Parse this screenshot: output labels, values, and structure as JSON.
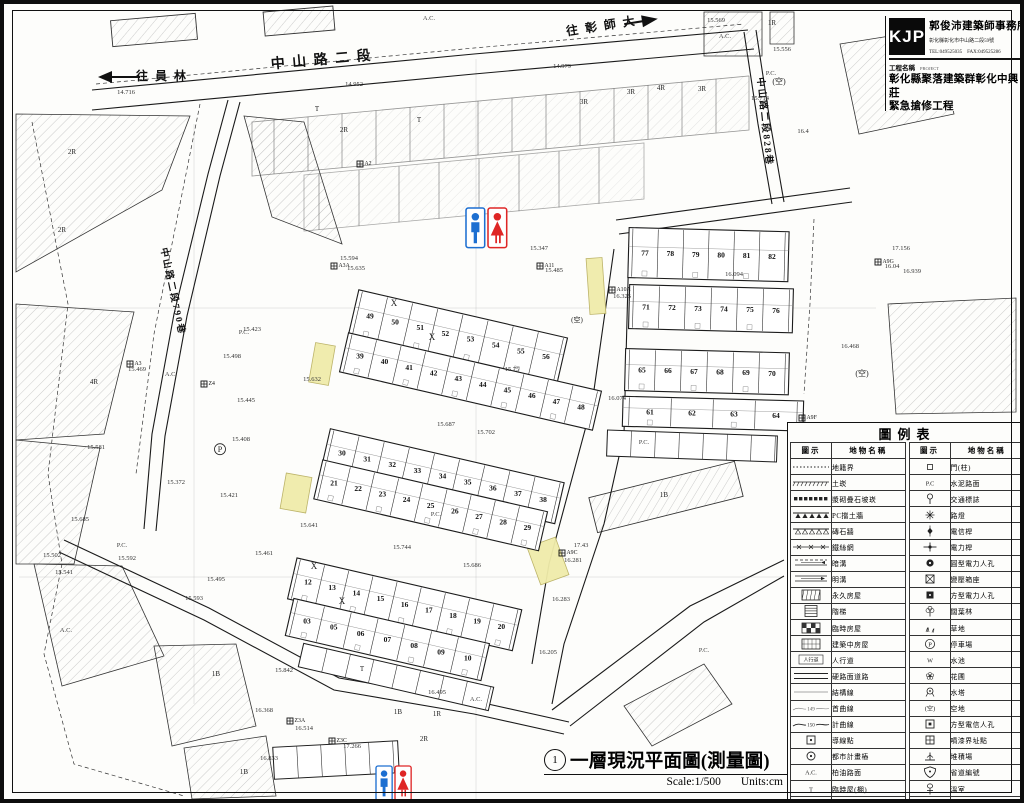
{
  "title_block": {
    "logo": "KJP",
    "office": "郭俊沛建築師事務所",
    "address": "彰化縣彰化市中山路二段59號",
    "tel_fax": "TEL:049525035　FAX:049525286",
    "project_label": "工程名稱",
    "project_label_en": "PROJECT",
    "project_name_line1": "彰化縣聚落建築群彰化中興莊",
    "project_name_line2": "緊急搶修工程"
  },
  "footer": {
    "number": "1",
    "title": "一層現況平面圖(測量圖)",
    "scale": "Scale:1/500",
    "units": "Units:cm"
  },
  "legend": {
    "title": "圖例表",
    "col_symbol": "圖示",
    "col_name": "地物名稱",
    "left": [
      {
        "sym": "dotted",
        "name": "地籍界"
      },
      {
        "sym": "ticks",
        "name": "土崁"
      },
      {
        "sym": "blocks",
        "name": "漿砌疊石坡崁"
      },
      {
        "sym": "tri_solid",
        "name": "PC擋土牆"
      },
      {
        "sym": "tri_open",
        "name": "磚石牆"
      },
      {
        "sym": "xfence",
        "name": "鐵絲網"
      },
      {
        "sym": "ditch_dash",
        "name": "暗溝"
      },
      {
        "sym": "ditch_solid",
        "name": "明溝"
      },
      {
        "sym": "hatch_box",
        "name": "永久房屋"
      },
      {
        "sym": "stairs",
        "name": "階梯"
      },
      {
        "sym": "checker_box",
        "name": "臨時房屋"
      },
      {
        "sym": "hatch_box2",
        "name": "建築中房屋"
      },
      {
        "sym": "sidewalk",
        "name": "人行道",
        "symText": "人行道"
      },
      {
        "sym": "dbl_line",
        "name": "硬路面道路"
      },
      {
        "sym": "thin_line",
        "name": "結構線"
      },
      {
        "sym": "contour",
        "name": "首曲線",
        "symText": "149"
      },
      {
        "sym": "contour2",
        "name": "計曲線",
        "symText": "150"
      },
      {
        "sym": "sq_dot",
        "name": "導線點"
      },
      {
        "sym": "circ_dot",
        "name": "都市計畫樁"
      },
      {
        "sym": "textsym",
        "name": "柏油路面",
        "symText": "A.C."
      },
      {
        "sym": "textsym",
        "name": "臨時屋(棚)",
        "symText": "T"
      },
      {
        "sym": "brick_house",
        "name": "磚砌屋"
      }
    ],
    "right": [
      {
        "sym": "sq_tiny",
        "name": "門(柱)"
      },
      {
        "sym": "textsym",
        "name": "水泥路面",
        "symText": "P.C"
      },
      {
        "sym": "traffic",
        "name": "交通標誌"
      },
      {
        "sym": "light",
        "name": "路燈"
      },
      {
        "sym": "pole_t",
        "name": "電信桿"
      },
      {
        "sym": "pole_e",
        "name": "電力桿"
      },
      {
        "sym": "mh_round",
        "name": "圓型電力人孔"
      },
      {
        "sym": "transformer",
        "name": "變壓箱座"
      },
      {
        "sym": "mh_square",
        "name": "方型電力人孔"
      },
      {
        "sym": "tree",
        "name": "闊葉林"
      },
      {
        "sym": "grass",
        "name": "草地"
      },
      {
        "sym": "parkP",
        "name": "停車場",
        "symText": "P"
      },
      {
        "sym": "textsym",
        "name": "水池",
        "symText": "W"
      },
      {
        "sym": "flower",
        "name": "花圃"
      },
      {
        "sym": "wtower",
        "name": "水塔"
      },
      {
        "sym": "textsym",
        "name": "空地",
        "symText": "(空)"
      },
      {
        "sym": "mh_tel",
        "name": "方型電信人孔"
      },
      {
        "sym": "paint_pt",
        "name": "噴漆界址點"
      },
      {
        "sym": "pile",
        "name": "堆積場"
      },
      {
        "sym": "shield",
        "name": "省道編號"
      },
      {
        "sym": "greenhouse",
        "name": "溫室"
      },
      {
        "sym": "flow",
        "name": "水流方向"
      }
    ]
  },
  "map": {
    "colors": {
      "highlight": "#f0ecaa",
      "highlight_border": "#b9b062",
      "man_blue": "#1d6fd1",
      "woman_red": "#df2626",
      "ink": "#1a1a1a"
    },
    "central_angle": 13,
    "right_angle": 1.5,
    "central_rows": [
      {
        "nums": [
          "49",
          "50",
          "51",
          "52",
          "53",
          "54",
          "55",
          "56"
        ],
        "x": 366,
        "y": 312,
        "dx": 25.8,
        "h": 46
      },
      {
        "nums": [
          "39",
          "40",
          "41",
          "42",
          "43",
          "44",
          "45",
          "46",
          "47",
          "48"
        ],
        "x": 356,
        "y": 352,
        "dx": 25.2,
        "h": 40
      },
      {
        "nums": [
          "30",
          "31",
          "32",
          "33",
          "34",
          "35",
          "36",
          "37",
          "38"
        ],
        "x": 338,
        "y": 449,
        "dx": 25.8,
        "h": 42
      },
      {
        "nums": [
          "21",
          "22",
          "23",
          "24",
          "25",
          "26",
          "27",
          "28",
          "29"
        ],
        "x": 330,
        "y": 479,
        "dx": 24.8,
        "h": 40
      },
      {
        "nums": [
          "12",
          "13",
          "14",
          "15",
          "16",
          "17",
          "18",
          "19",
          "20"
        ],
        "x": 304,
        "y": 578,
        "dx": 24.8,
        "h": 42
      },
      {
        "nums": [
          "03",
          "05",
          "06",
          "07",
          "08",
          "09",
          "10"
        ],
        "x": 303,
        "y": 617,
        "dx": 27.5,
        "h": 38
      }
    ],
    "right_rows": [
      {
        "nums": [
          "77",
          "78",
          "79",
          "80",
          "81",
          "82"
        ],
        "x": 641,
        "y": 249,
        "dx": 25.4,
        "h": 50
      },
      {
        "nums": [
          "71",
          "72",
          "73",
          "74",
          "75",
          "76"
        ],
        "x": 642,
        "y": 303,
        "dx": 26,
        "h": 44
      },
      {
        "nums": [
          "65",
          "66",
          "67",
          "68",
          "69",
          "70"
        ],
        "x": 638,
        "y": 366,
        "dx": 26,
        "h": 42
      },
      {
        "nums": [
          "61",
          "62",
          "63",
          "64"
        ],
        "x": 646,
        "y": 408,
        "dx": 42,
        "h": 30
      }
    ],
    "markers": [
      {
        "c": "A2",
        "x": 356,
        "y": 160
      },
      {
        "c": "Z4",
        "x": 200,
        "y": 380
      },
      {
        "c": "A3",
        "x": 126,
        "y": 360
      },
      {
        "c": "A3A",
        "x": 330,
        "y": 262
      },
      {
        "c": "A11",
        "x": 536,
        "y": 262
      },
      {
        "c": "A10A",
        "x": 608,
        "y": 286
      },
      {
        "c": "A9G",
        "x": 874,
        "y": 258
      },
      {
        "c": "A9C",
        "x": 558,
        "y": 549
      },
      {
        "c": "A9F",
        "x": 798,
        "y": 414
      },
      {
        "c": "Z3A",
        "x": 286,
        "y": 717
      },
      {
        "c": "Z3C",
        "x": 328,
        "y": 737
      }
    ],
    "labels": [
      {
        "t": "中 山 路 二 段",
        "x": 318,
        "y": 60,
        "s": 14,
        "r": -5,
        "k": "road"
      },
      {
        "t": "往 彰 師 大",
        "x": 598,
        "y": 26,
        "s": 12,
        "r": -9,
        "k": "road"
      },
      {
        "t": "往 員 林",
        "x": 158,
        "y": 76,
        "s": 12,
        "r": 0,
        "k": "road"
      },
      {
        "t": "中山路二段790巷",
        "x": 166,
        "y": 288,
        "s": 9.5,
        "r": 78,
        "k": "road"
      },
      {
        "t": "中山路二段828巷",
        "x": 758,
        "y": 118,
        "s": 9.5,
        "r": 84,
        "k": "road"
      },
      {
        "t": "(空)",
        "x": 775,
        "y": 80,
        "s": 8,
        "k": "area"
      },
      {
        "t": "(空)",
        "x": 858,
        "y": 372,
        "s": 8,
        "k": "area"
      },
      {
        "t": "(空)",
        "x": 573,
        "y": 318,
        "s": 7,
        "k": "area"
      },
      {
        "t": "1R",
        "x": 768,
        "y": 21,
        "s": 7,
        "k": "area"
      },
      {
        "t": "1R",
        "x": 433,
        "y": 712,
        "s": 7,
        "k": "area"
      },
      {
        "t": "2R",
        "x": 68,
        "y": 150,
        "s": 7,
        "k": "area"
      },
      {
        "t": "2R",
        "x": 58,
        "y": 228,
        "s": 7,
        "k": "area"
      },
      {
        "t": "2R",
        "x": 340,
        "y": 128,
        "s": 7,
        "k": "area"
      },
      {
        "t": "2R",
        "x": 420,
        "y": 737,
        "s": 7,
        "k": "area"
      },
      {
        "t": "3R",
        "x": 580,
        "y": 100,
        "s": 7,
        "k": "area"
      },
      {
        "t": "3R",
        "x": 627,
        "y": 90,
        "s": 7,
        "k": "area"
      },
      {
        "t": "4R",
        "x": 657,
        "y": 86,
        "s": 7,
        "k": "area"
      },
      {
        "t": "3R",
        "x": 698,
        "y": 87,
        "s": 7,
        "k": "area"
      },
      {
        "t": "4R",
        "x": 90,
        "y": 380,
        "s": 7,
        "k": "area"
      },
      {
        "t": "1B",
        "x": 212,
        "y": 672,
        "s": 7,
        "k": "area"
      },
      {
        "t": "1B",
        "x": 240,
        "y": 770,
        "s": 7,
        "k": "area"
      },
      {
        "t": "1B",
        "x": 394,
        "y": 710,
        "s": 7,
        "k": "area"
      },
      {
        "t": "1B",
        "x": 660,
        "y": 493,
        "s": 7,
        "k": "area"
      },
      {
        "t": "T",
        "x": 313,
        "y": 107,
        "s": 7,
        "k": "area"
      },
      {
        "t": "T",
        "x": 415,
        "y": 118,
        "s": 7,
        "k": "area"
      },
      {
        "t": "T",
        "x": 358,
        "y": 667,
        "s": 7,
        "k": "area"
      },
      {
        "t": "P.C.",
        "x": 240,
        "y": 330,
        "s": 6.5,
        "k": "surf"
      },
      {
        "t": "P.C.",
        "x": 118,
        "y": 543,
        "s": 6.5,
        "k": "surf"
      },
      {
        "t": "P.C.",
        "x": 432,
        "y": 512,
        "s": 6.5,
        "k": "surf"
      },
      {
        "t": "P.C.",
        "x": 767,
        "y": 71,
        "s": 6.5,
        "k": "surf"
      },
      {
        "t": "P.C.",
        "x": 640,
        "y": 440,
        "s": 6.5,
        "k": "surf"
      },
      {
        "t": "P.C.",
        "x": 700,
        "y": 648,
        "s": 6.5,
        "k": "surf"
      },
      {
        "t": "A.C.",
        "x": 167,
        "y": 372,
        "s": 6.5,
        "k": "surf"
      },
      {
        "t": "A.C.",
        "x": 721,
        "y": 34,
        "s": 6.5,
        "k": "surf"
      },
      {
        "t": "A.C.",
        "x": 62,
        "y": 628,
        "s": 6.5,
        "k": "surf"
      },
      {
        "t": "A.C.",
        "x": 472,
        "y": 697,
        "s": 6.5,
        "k": "surf"
      },
      {
        "t": "A.C.",
        "x": 425,
        "y": 16,
        "s": 6.5,
        "k": "surf"
      },
      {
        "t": "14.716",
        "x": 122,
        "y": 90,
        "s": 6.5,
        "k": "elev"
      },
      {
        "t": "14.952",
        "x": 350,
        "y": 82,
        "s": 6.5,
        "k": "elev"
      },
      {
        "t": "14.979",
        "x": 558,
        "y": 64,
        "s": 6.5,
        "k": "elev"
      },
      {
        "t": "15.569",
        "x": 712,
        "y": 18,
        "s": 6.5,
        "k": "elev"
      },
      {
        "t": "15.556",
        "x": 778,
        "y": 47,
        "s": 6.5,
        "k": "elev"
      },
      {
        "t": "15.714",
        "x": 756,
        "y": 96,
        "s": 6.5,
        "k": "elev"
      },
      {
        "t": "16.4",
        "x": 799,
        "y": 129,
        "s": 6.5,
        "k": "elev"
      },
      {
        "t": "17.156",
        "x": 897,
        "y": 246,
        "s": 6.5,
        "k": "elev"
      },
      {
        "t": "16.939",
        "x": 908,
        "y": 269,
        "s": 6.5,
        "k": "elev"
      },
      {
        "t": "16.468",
        "x": 846,
        "y": 344,
        "s": 6.5,
        "k": "elev"
      },
      {
        "t": "16.04",
        "x": 888,
        "y": 264,
        "s": 6.5,
        "k": "elev"
      },
      {
        "t": "16.64",
        "x": 812,
        "y": 422,
        "s": 6.5,
        "k": "elev"
      },
      {
        "t": "15.594",
        "x": 345,
        "y": 256,
        "s": 6.5,
        "k": "elev"
      },
      {
        "t": "15.635",
        "x": 352,
        "y": 266,
        "s": 6.5,
        "k": "elev"
      },
      {
        "t": "15.347",
        "x": 535,
        "y": 246,
        "s": 6.5,
        "k": "elev"
      },
      {
        "t": "15.485",
        "x": 550,
        "y": 268,
        "s": 6.5,
        "k": "elev"
      },
      {
        "t": "15.423",
        "x": 248,
        "y": 327,
        "s": 6.5,
        "k": "elev"
      },
      {
        "t": "15.498",
        "x": 228,
        "y": 354,
        "s": 6.5,
        "k": "elev"
      },
      {
        "t": "15.469",
        "x": 133,
        "y": 367,
        "s": 6.5,
        "k": "elev"
      },
      {
        "t": "15.445",
        "x": 242,
        "y": 398,
        "s": 6.5,
        "k": "elev"
      },
      {
        "t": "15.408",
        "x": 237,
        "y": 437,
        "s": 6.5,
        "k": "elev"
      },
      {
        "t": "15.372",
        "x": 172,
        "y": 480,
        "s": 6.5,
        "k": "elev"
      },
      {
        "t": "15.421",
        "x": 225,
        "y": 493,
        "s": 6.5,
        "k": "elev"
      },
      {
        "t": "15.685",
        "x": 76,
        "y": 517,
        "s": 6.5,
        "k": "elev"
      },
      {
        "t": "15.581",
        "x": 92,
        "y": 445,
        "s": 6.5,
        "k": "elev"
      },
      {
        "t": "15.592",
        "x": 123,
        "y": 556,
        "s": 6.5,
        "k": "elev"
      },
      {
        "t": "15.461",
        "x": 260,
        "y": 551,
        "s": 6.5,
        "k": "elev"
      },
      {
        "t": "15.495",
        "x": 212,
        "y": 577,
        "s": 6.5,
        "k": "elev"
      },
      {
        "t": "15.593",
        "x": 190,
        "y": 596,
        "s": 6.5,
        "k": "elev"
      },
      {
        "t": "15.502",
        "x": 48,
        "y": 553,
        "s": 6.5,
        "k": "elev"
      },
      {
        "t": "15.541",
        "x": 60,
        "y": 570,
        "s": 6.5,
        "k": "elev"
      },
      {
        "t": "15.632",
        "x": 308,
        "y": 377,
        "s": 6.5,
        "k": "elev"
      },
      {
        "t": "15.641",
        "x": 305,
        "y": 523,
        "s": 6.5,
        "k": "elev"
      },
      {
        "t": "15.75",
        "x": 508,
        "y": 367,
        "s": 6.5,
        "k": "elev"
      },
      {
        "t": "15.702",
        "x": 482,
        "y": 430,
        "s": 6.5,
        "k": "elev"
      },
      {
        "t": "15.687",
        "x": 442,
        "y": 422,
        "s": 6.5,
        "k": "elev"
      },
      {
        "t": "15.744",
        "x": 398,
        "y": 545,
        "s": 6.5,
        "k": "elev"
      },
      {
        "t": "15.686",
        "x": 468,
        "y": 563,
        "s": 6.5,
        "k": "elev"
      },
      {
        "t": "16.094",
        "x": 730,
        "y": 272,
        "s": 6.5,
        "k": "elev"
      },
      {
        "t": "16.325",
        "x": 618,
        "y": 294,
        "s": 6.5,
        "k": "elev"
      },
      {
        "t": "16.074",
        "x": 613,
        "y": 396,
        "s": 6.5,
        "k": "elev"
      },
      {
        "t": "16.283",
        "x": 557,
        "y": 597,
        "s": 6.5,
        "k": "elev"
      },
      {
        "t": "16.205",
        "x": 544,
        "y": 650,
        "s": 6.5,
        "k": "elev"
      },
      {
        "t": "17.43",
        "x": 577,
        "y": 543,
        "s": 6.5,
        "k": "elev"
      },
      {
        "t": "16.281",
        "x": 569,
        "y": 558,
        "s": 6.5,
        "k": "elev"
      },
      {
        "t": "16.495",
        "x": 433,
        "y": 690,
        "s": 6.5,
        "k": "elev"
      },
      {
        "t": "16.368",
        "x": 260,
        "y": 708,
        "s": 6.5,
        "k": "elev"
      },
      {
        "t": "15.842",
        "x": 280,
        "y": 668,
        "s": 6.5,
        "k": "elev"
      },
      {
        "t": "16.514",
        "x": 300,
        "y": 726,
        "s": 6.5,
        "k": "elev"
      },
      {
        "t": "17.266",
        "x": 348,
        "y": 744,
        "s": 6.5,
        "k": "elev"
      },
      {
        "t": "16.833",
        "x": 265,
        "y": 756,
        "s": 6.5,
        "k": "elev"
      },
      {
        "t": "X",
        "x": 390,
        "y": 302,
        "s": 9,
        "k": "xmark"
      },
      {
        "t": "X",
        "x": 428,
        "y": 336,
        "s": 9,
        "k": "xmark"
      },
      {
        "t": "X",
        "x": 310,
        "y": 565,
        "s": 9,
        "k": "xmark"
      },
      {
        "t": "X",
        "x": 338,
        "y": 600,
        "s": 9,
        "k": "xmark"
      },
      {
        "t": "P",
        "x": 216,
        "y": 448,
        "s": 8,
        "k": "circP"
      }
    ],
    "highlights": [
      {
        "x": 318,
        "y": 360,
        "w": 20,
        "h": 40,
        "r": 10
      },
      {
        "x": 292,
        "y": 489,
        "w": 26,
        "h": 36,
        "r": 10
      },
      {
        "x": 544,
        "y": 557,
        "w": 30,
        "h": 40,
        "r": -20
      },
      {
        "x": 592,
        "y": 282,
        "w": 16,
        "h": 56,
        "r": -4
      }
    ],
    "restrooms": [
      {
        "x": 462,
        "y": 204,
        "s": 1.1
      },
      {
        "x": 372,
        "y": 762,
        "s": 0.95
      }
    ]
  }
}
